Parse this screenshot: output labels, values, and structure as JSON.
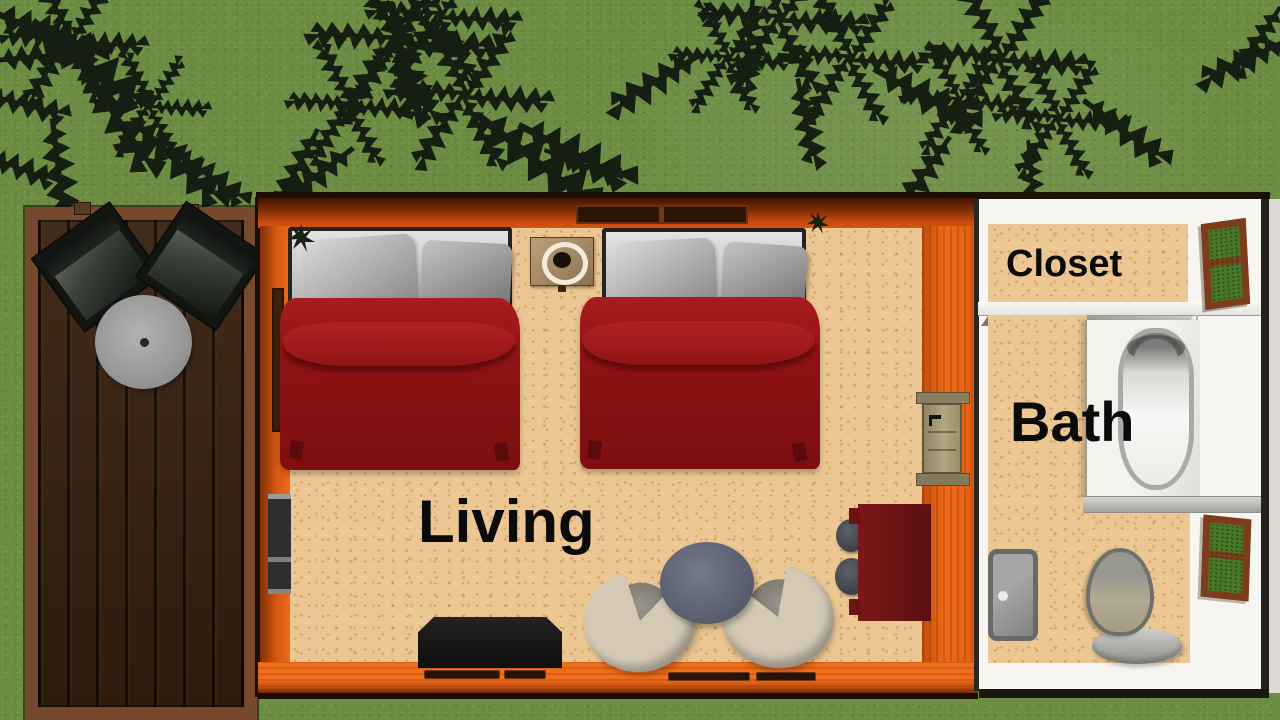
{
  "labels": {
    "living": "Living",
    "closet": "Closet",
    "bath": "Bath"
  },
  "palette": {
    "grass_green": "#6c8c43",
    "tree_silhouette": "#131b11",
    "deck_plank_brown": "#37200f",
    "deck_frame_brown": "#74492e",
    "wall_orange": "#ef6a16",
    "wall_dark_red_top": "#431402",
    "floor_tan": "#ecc793",
    "blanket_red": "#8e1314",
    "mattress_gray": "#c9c9c9",
    "interior_wall_white": "#f6f5f1",
    "window_frame_brown": "#7d3c1c",
    "window_pane_green": "#4c772a",
    "desk_dark_red": "#6e1314",
    "label_text": "#0b0b0b"
  },
  "furniture": {
    "deck": [
      "deck-chair",
      "deck-chair",
      "patio-table"
    ],
    "living": [
      "double-bed",
      "double-bed",
      "nightstand-with-lamp",
      "tv-console",
      "tub-chair",
      "tub-chair",
      "coffee-table",
      "desk",
      "desk-chair",
      "desk-chair",
      "wood-stove",
      "interior-door"
    ],
    "closet": [
      "window"
    ],
    "bath": [
      "bathtub",
      "vanity-counter",
      "sink",
      "toilet",
      "window"
    ]
  }
}
